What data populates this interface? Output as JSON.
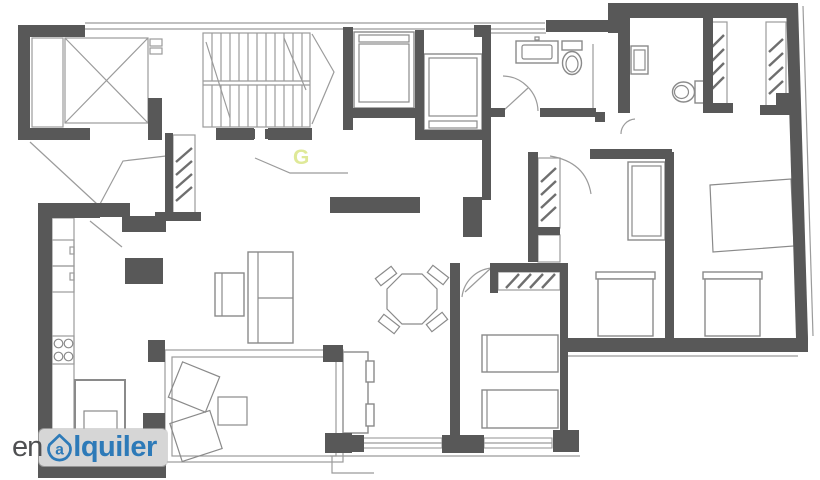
{
  "watermark": {
    "prefix": "en",
    "a_letter": "a",
    "suffix": "lquiler",
    "brand": "enalquiler"
  },
  "marker": {
    "label": "G"
  },
  "colors": {
    "wall": "#585858",
    "line": "#9b9b9b",
    "furniture": "#8a8a8a",
    "hatch": "#6f6f6f",
    "highlight": "#dfe998",
    "logo_blue": "#2d7ab8",
    "logo_gray": "#4f5052",
    "logo_bg": "#d6d6d6",
    "background": "#ffffff"
  }
}
